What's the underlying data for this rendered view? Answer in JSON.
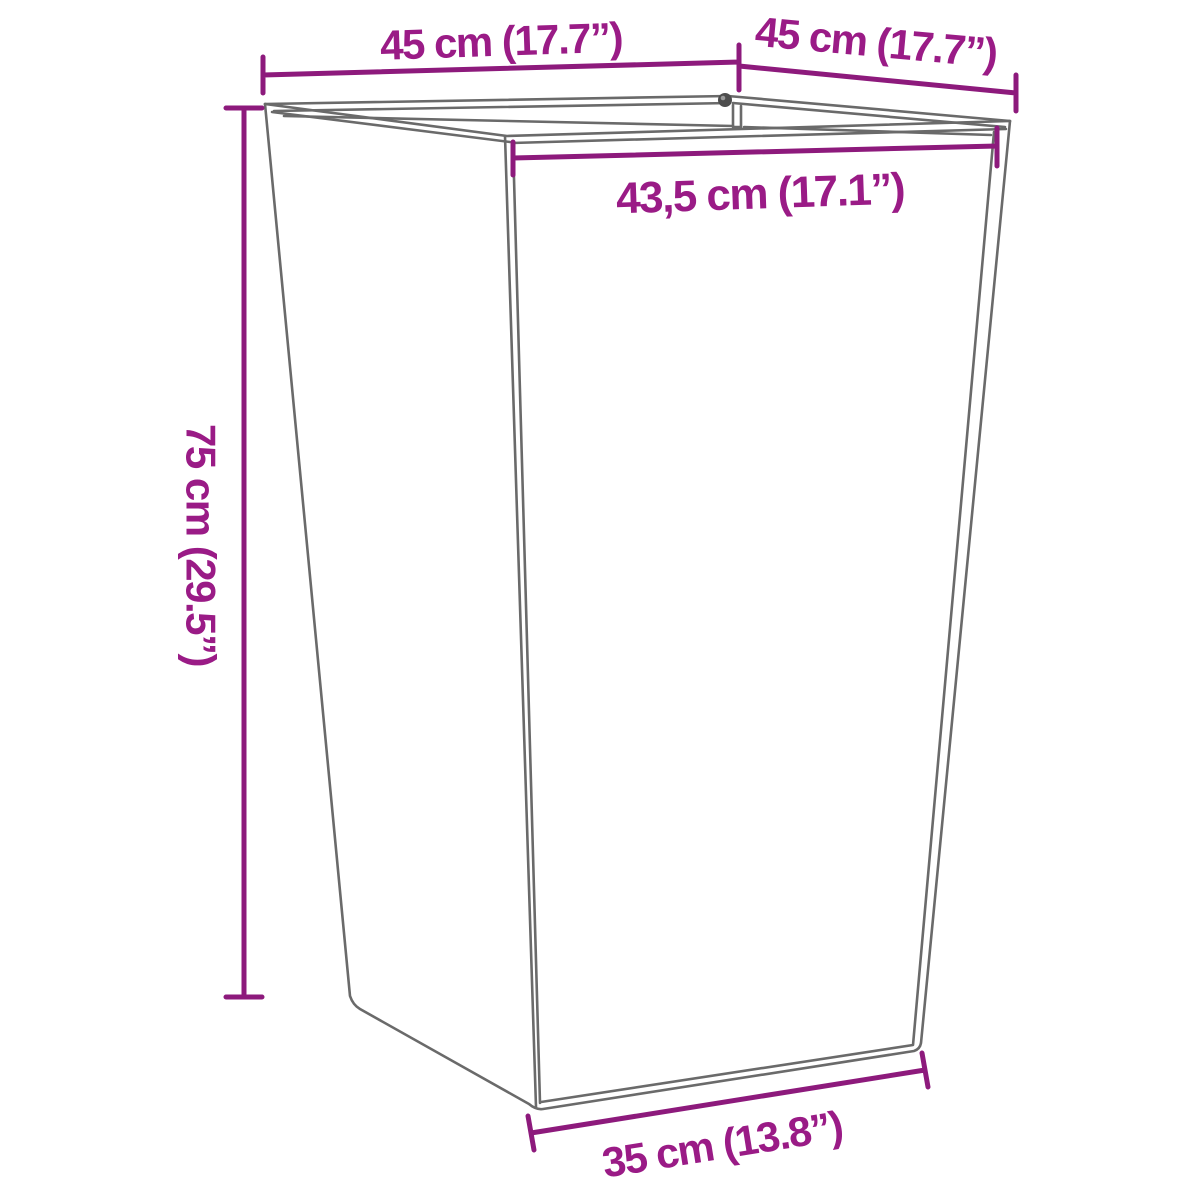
{
  "page": {
    "background": "#ffffff"
  },
  "colors": {
    "dimension_line": "#8d1a7c",
    "label_text": "#9a1b86",
    "drawing_line": "#6a6a6a",
    "screw_dark": "#4d4d4d",
    "screw_light": "#9a9a9a"
  },
  "labels": {
    "top_left_width": "45 cm (17.7”)",
    "top_right_width": "45 cm (17.7”)",
    "inner_top_width": "43,5 cm (17.1”)",
    "height": "75 cm (29.5”)",
    "bottom_width": "35 cm (13.8”)"
  }
}
